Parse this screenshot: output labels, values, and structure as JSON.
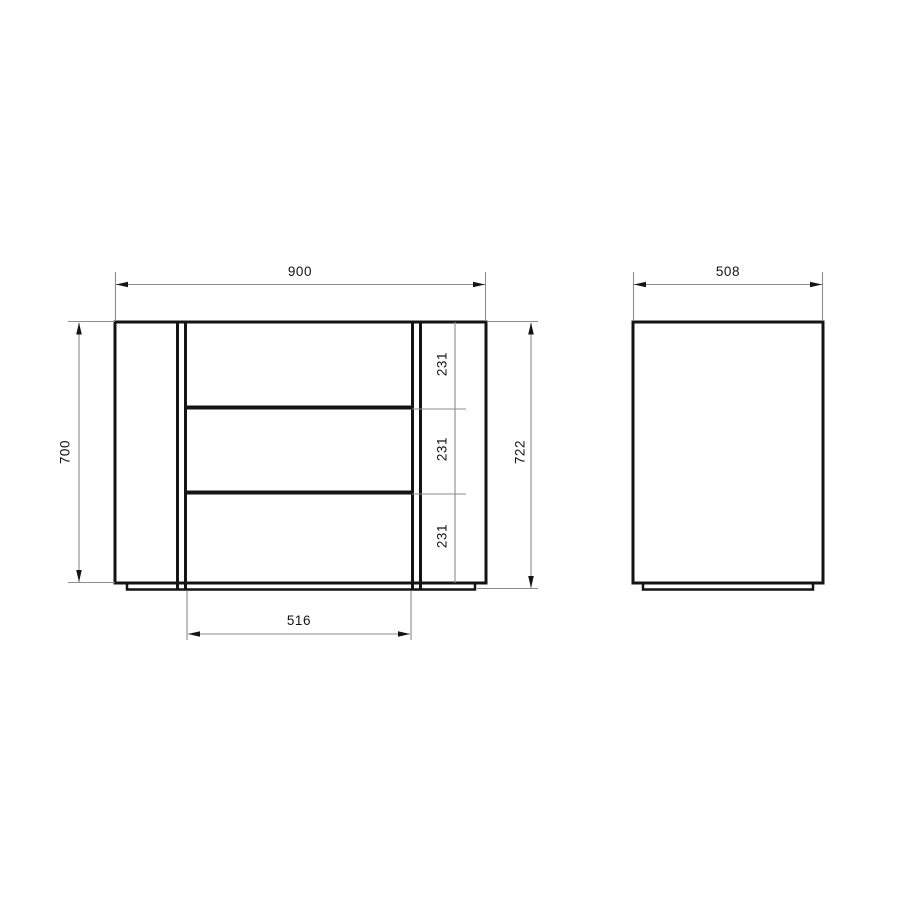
{
  "colors": {
    "background": "#ffffff",
    "object_line": "#141414",
    "dim_line": "#8d8d8d",
    "arrow": "#141414",
    "text": "#141414"
  },
  "dimensions": {
    "front_width": "900",
    "side_depth": "508",
    "body_height": "700",
    "total_height": "722",
    "inner_width": "516",
    "drawer_heights": [
      "231",
      "231",
      "231"
    ]
  }
}
